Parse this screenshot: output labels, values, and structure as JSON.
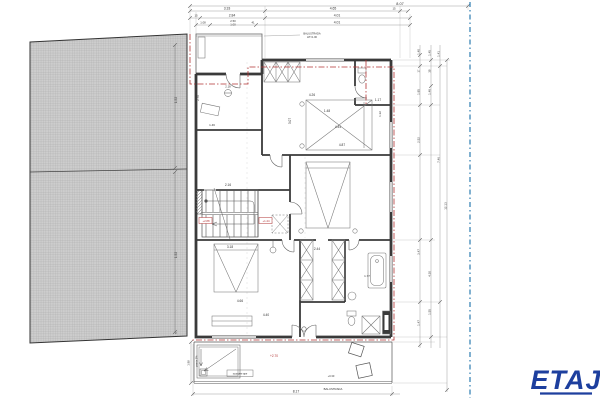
{
  "title": {
    "text": "ETAJ"
  },
  "colors": {
    "accent-blue": "#1d3f9e",
    "marker-red": "#b23434",
    "property-blue": "#2b7bb0",
    "wall": "#3a3a3a"
  },
  "plan_labels": [
    {
      "t": "8.07",
      "x": 400,
      "y": 5
    },
    {
      "t": "3.33",
      "x": 227,
      "y": 9.6,
      "s": 3.4
    },
    {
      "t": "4.65",
      "x": 333,
      "y": 9.6,
      "s": 3.4
    },
    {
      "t": "15",
      "x": 394,
      "y": 9.6,
      "s": 2.8
    },
    {
      "t": "15",
      "x": 196,
      "y": 16.6,
      "s": 2.8
    },
    {
      "t": "2.84",
      "x": 232,
      "y": 16.6,
      "s": 3.4
    },
    {
      "t": "4.01",
      "x": 337,
      "y": 16.6,
      "s": 3.4
    },
    {
      "t": "1.08",
      "x": 203,
      "y": 23.6,
      "s": 2.8
    },
    {
      "t": "2.50",
      "x": 233,
      "y": 21.8,
      "s": 2.8
    },
    {
      "t": "1.00",
      "x": 233,
      "y": 25.4,
      "s": 2.8
    },
    {
      "t": "41",
      "x": 253,
      "y": 23.6,
      "s": 2.8
    },
    {
      "t": "4.01",
      "x": 337,
      "y": 23.6,
      "s": 3.4
    },
    {
      "t": "1.52",
      "x": 177,
      "y": 100,
      "r": -90,
      "s": 3.2
    },
    {
      "t": "1.52",
      "x": 177,
      "y": 255,
      "r": -90,
      "s": 3.2
    },
    {
      "t": "5",
      "x": 177,
      "y": 333,
      "r": -90,
      "s": 2.8
    },
    {
      "t": "BALUSTRADA",
      "x": 312,
      "y": 34.5,
      "s": 2.6
    },
    {
      "t": "HT=1.00",
      "x": 312,
      "y": 38,
      "s": 2.6
    },
    {
      "t": "4.26",
      "x": 312,
      "y": 96,
      "s": 3.2
    },
    {
      "t": "1.48",
      "x": 327,
      "y": 112,
      "s": 3.2
    },
    {
      "t": "4.44",
      "x": 338,
      "y": 128,
      "s": 3.2
    },
    {
      "t": "3.07",
      "x": 291,
      "y": 121,
      "r": -90,
      "s": 3.2
    },
    {
      "t": "4.87",
      "x": 342,
      "y": 146,
      "s": 3.2
    },
    {
      "t": "1.17",
      "x": 378,
      "y": 101,
      "s": 3.2
    },
    {
      "t": "1.32",
      "x": 381,
      "y": 114,
      "r": -90,
      "s": 3
    },
    {
      "t": "2.16",
      "x": 228,
      "y": 186,
      "s": 3.2
    },
    {
      "t": "3.18",
      "x": 230,
      "y": 248,
      "s": 3.2
    },
    {
      "t": "4.66",
      "x": 240,
      "y": 302,
      "s": 3.2
    },
    {
      "t": "4.40",
      "x": 266,
      "y": 316,
      "s": 3.2
    },
    {
      "t": "2.44",
      "x": 317,
      "y": 250,
      "s": 3.2
    },
    {
      "t": "1.77",
      "x": 367,
      "y": 277,
      "s": 3
    },
    {
      "t": "1.46",
      "x": 212,
      "y": 126,
      "s": 3
    },
    {
      "t": "2.70",
      "x": 199,
      "y": 98,
      "r": -90,
      "s": 3
    },
    {
      "t": "2.18",
      "x": 228,
      "y": 87.5,
      "s": 2.8
    },
    {
      "t": "+2.88",
      "x": 206,
      "y": 221.8,
      "s": 2.8,
      "red": true
    },
    {
      "t": "+1.44",
      "x": 266,
      "y": 221.8,
      "s": 2.8,
      "red": true
    },
    {
      "t": "+2.70",
      "x": 274,
      "y": 357,
      "s": 3.2,
      "red": true
    },
    {
      "t": "panta 2%",
      "x": 197.5,
      "y": 361,
      "r": -90,
      "s": 2.6
    },
    {
      "t": "scurgere ape",
      "x": 240,
      "y": 374.6,
      "s": 2.5
    },
    {
      "t": "+0.30",
      "x": 331,
      "y": 377,
      "s": 2.6
    },
    {
      "t": "BALUSTRADA",
      "x": 333,
      "y": 390,
      "s": 2.8
    },
    {
      "t": "8.17",
      "x": 296,
      "y": 392.5,
      "s": 3.4
    },
    {
      "t": "1.98",
      "x": 189.5,
      "y": 363,
      "r": -90,
      "s": 2.8
    },
    {
      "t": "1.40",
      "x": 419.5,
      "y": 52,
      "r": -90,
      "s": 3
    },
    {
      "t": "1.45",
      "x": 430.5,
      "y": 53,
      "r": -90,
      "s": 3
    },
    {
      "t": "1.41",
      "x": 439.5,
      "y": 54,
      "r": -90,
      "s": 3
    },
    {
      "t": "17",
      "x": 419.5,
      "y": 71,
      "r": -90,
      "s": 2.6
    },
    {
      "t": "38",
      "x": 430.5,
      "y": 71,
      "r": -90,
      "s": 2.6
    },
    {
      "t": "1.85",
      "x": 419.5,
      "y": 92,
      "r": -90,
      "s": 3
    },
    {
      "t": "1.48",
      "x": 430.5,
      "y": 92,
      "r": -90,
      "s": 3
    },
    {
      "t": "2.52",
      "x": 419.5,
      "y": 140,
      "r": -90,
      "s": 3
    },
    {
      "t": "7.46",
      "x": 439.5,
      "y": 160,
      "r": -90,
      "s": 3
    },
    {
      "t": "12.13",
      "x": 446.5,
      "y": 206,
      "r": -90,
      "s": 3
    },
    {
      "t": "3.47",
      "x": 419.5,
      "y": 252,
      "r": -90,
      "s": 3
    },
    {
      "t": "4.30",
      "x": 430.5,
      "y": 274,
      "r": -90,
      "s": 3
    },
    {
      "t": "1.55",
      "x": 430.5,
      "y": 312,
      "r": -90,
      "s": 3
    },
    {
      "t": "1.47",
      "x": 419.5,
      "y": 323,
      "r": -90,
      "s": 3
    }
  ]
}
